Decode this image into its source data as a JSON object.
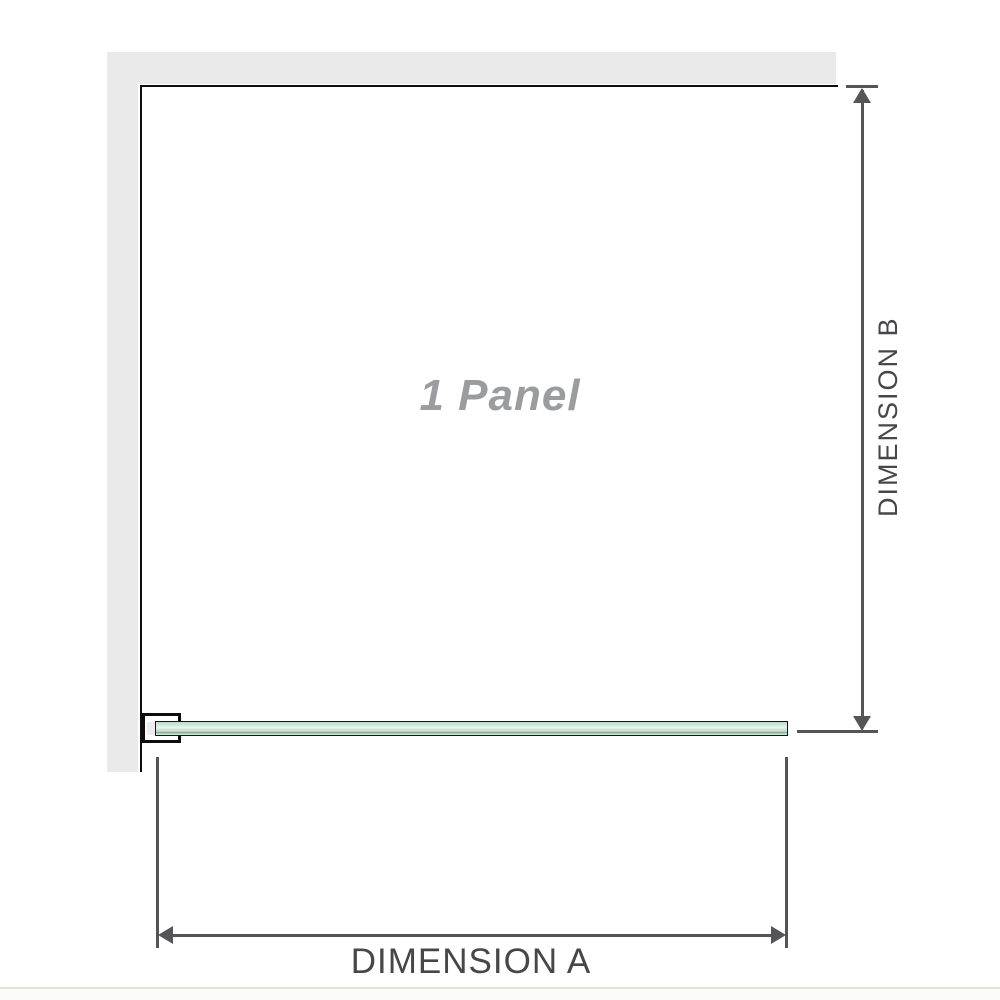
{
  "diagram": {
    "panel_label": "1 Panel",
    "dimension_a_label": "DIMENSION A",
    "dimension_b_label": "DIMENSION B",
    "colors": {
      "wall": "#eaeaea",
      "panel_outline": "#0f0f0f",
      "bracket_outline": "#0c0c0c",
      "glass_green_light": "#ecf5ef",
      "glass_green_mid": "#c0dfcd",
      "glass_green_dark_line": "#93a99b",
      "dimension_lines": "#555557",
      "dimension_text": "#47474a",
      "panel_label_text": "#9b9c9e",
      "footer_rule": "#e2e2dd"
    }
  }
}
